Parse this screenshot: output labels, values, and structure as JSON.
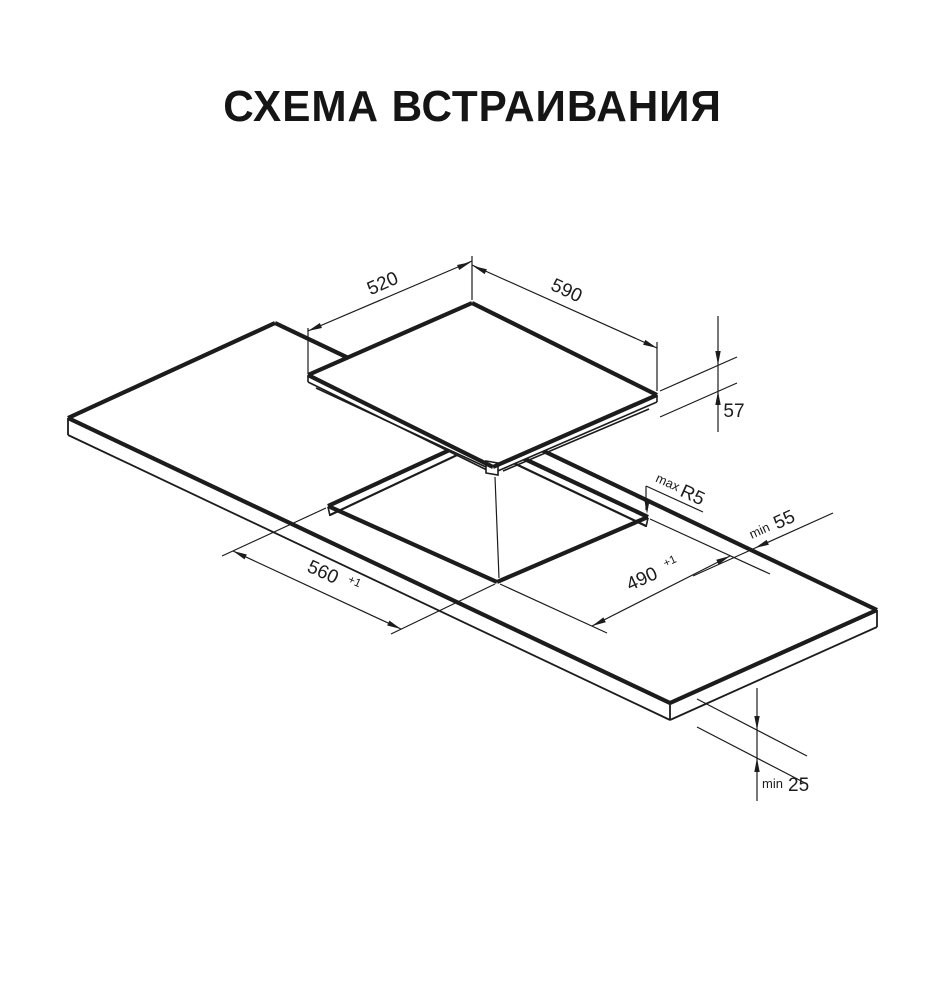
{
  "title": "СХЕМА ВСТРАИВАНИЯ",
  "colors": {
    "background": "#ffffff",
    "line": "#1c1c1c"
  },
  "diagram": {
    "type": "built-in cooktop installation scheme, isometric line drawing",
    "dimensions": {
      "hob_depth": "520",
      "hob_width": "590",
      "hob_height": "57",
      "corner_radius_prefix": "max",
      "corner_radius": "R5",
      "rear_clearance_prefix": "min",
      "rear_clearance": "55",
      "cutout_width": "560",
      "cutout_width_tolerance": "+1",
      "cutout_depth": "490",
      "cutout_depth_tolerance": "+1",
      "bottom_clearance_prefix": "min",
      "bottom_clearance": "25"
    }
  }
}
